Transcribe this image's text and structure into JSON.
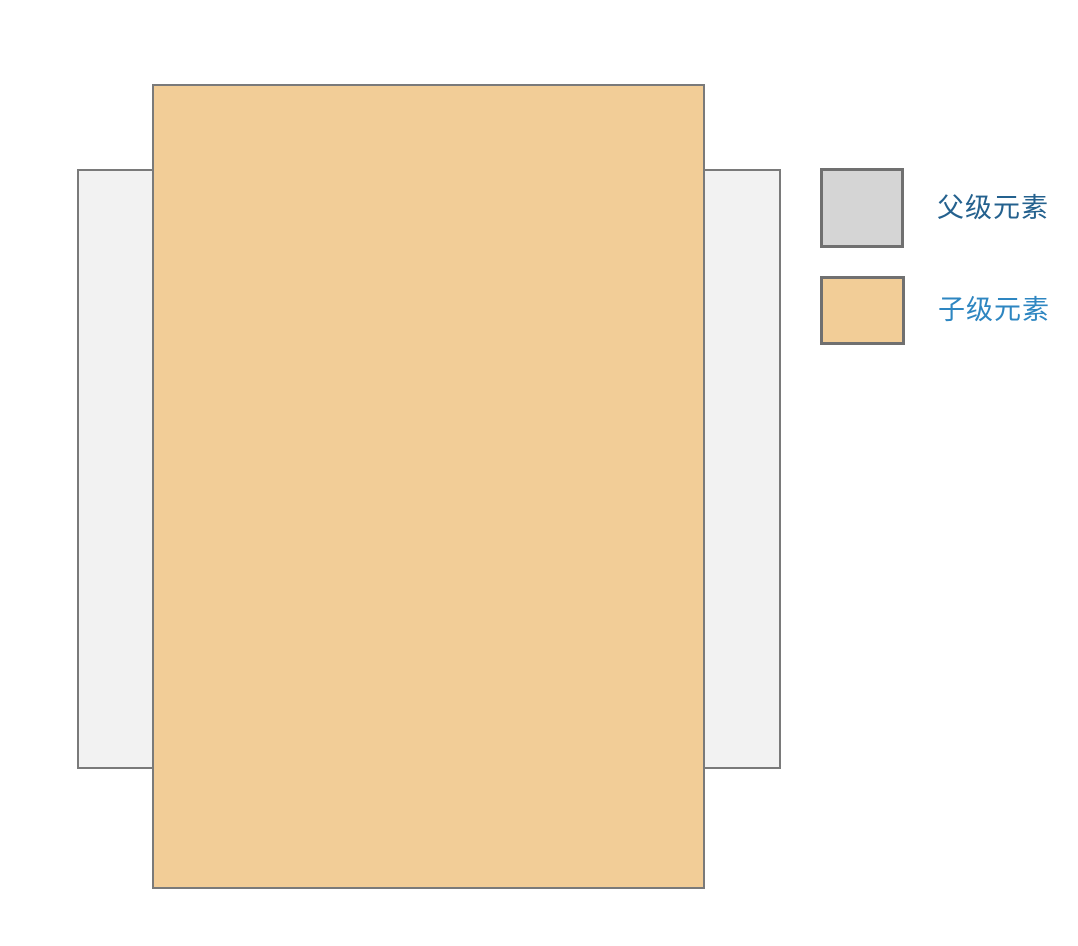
{
  "canvas": {
    "background": "#ffffff",
    "border_color": "#7a7a7a"
  },
  "diagram": {
    "parent_rect": {
      "name": "父级元素",
      "fill": "#f2f2f2",
      "border": "#7a7a7a"
    },
    "child_rect": {
      "name": "子级元素",
      "fill": "#f2cd97",
      "border": "#7a7a7a"
    }
  },
  "legend": {
    "items": [
      {
        "label": "父级元素",
        "swatch_fill": "#d5d5d5",
        "swatch_border": "#707070",
        "label_color": "#24618e"
      },
      {
        "label": "子级元素",
        "swatch_fill": "#f2cd97",
        "swatch_border": "#707070",
        "label_color": "#2e86c1"
      }
    ]
  }
}
